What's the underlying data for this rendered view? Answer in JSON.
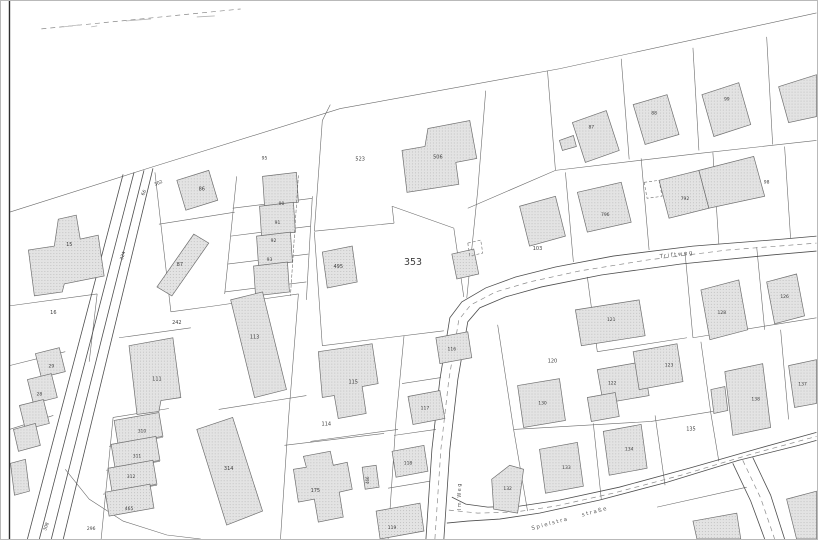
{
  "map": {
    "title_hint": "cadastral parcel map",
    "colors": {
      "background": "#ffffff",
      "boundary": "#6b6b6b",
      "road_edge": "#4e4e4e",
      "road_dash": "#8a8a8a",
      "building_fill": "#e3e3e3",
      "building_dot": "#c3c3c3",
      "building_stroke": "#6f6f6f",
      "label": "#3c3c3c",
      "street_text": "#5a5a5a",
      "frame": "#2e2e2e",
      "tick": "#b5b5b5"
    },
    "main_parcel": {
      "text": "353",
      "x": 413,
      "y": 265,
      "size": 9.5
    },
    "parcel_labels": [
      {
        "text": "523",
        "x": 360,
        "y": 160,
        "size": 5
      },
      {
        "text": "506",
        "x": 438,
        "y": 158,
        "size": 5
      },
      {
        "text": "495",
        "x": 338,
        "y": 268,
        "size": 5
      },
      {
        "text": "86",
        "x": 201,
        "y": 190,
        "size": 5
      },
      {
        "text": "87",
        "x": 179,
        "y": 266,
        "size": 5
      },
      {
        "text": "95",
        "x": 264,
        "y": 159,
        "size": 4.5
      },
      {
        "text": "90",
        "x": 281,
        "y": 205,
        "size": 4.5
      },
      {
        "text": "91",
        "x": 277,
        "y": 224,
        "size": 4.5
      },
      {
        "text": "92",
        "x": 273,
        "y": 242,
        "size": 4.5
      },
      {
        "text": "93",
        "x": 269,
        "y": 261,
        "size": 4.5
      },
      {
        "text": "15",
        "x": 68,
        "y": 246,
        "size": 5
      },
      {
        "text": "16",
        "x": 52,
        "y": 314,
        "size": 5
      },
      {
        "text": "324",
        "x": 123,
        "y": 256,
        "size": 4.5,
        "rot": -73
      },
      {
        "text": "66",
        "x": 144,
        "y": 193,
        "size": 4.5,
        "rot": -63
      },
      {
        "text": "302",
        "x": 158,
        "y": 184,
        "size": 4.5,
        "rot": -25
      },
      {
        "text": "242",
        "x": 176,
        "y": 324,
        "size": 5
      },
      {
        "text": "29",
        "x": 50,
        "y": 368,
        "size": 4.5
      },
      {
        "text": "28",
        "x": 38,
        "y": 396,
        "size": 4.5
      },
      {
        "text": "111",
        "x": 156,
        "y": 381,
        "size": 5
      },
      {
        "text": "310",
        "x": 141,
        "y": 433,
        "size": 4.5
      },
      {
        "text": "311",
        "x": 136,
        "y": 458,
        "size": 4.5
      },
      {
        "text": "312",
        "x": 130,
        "y": 479,
        "size": 4.5
      },
      {
        "text": "465",
        "x": 128,
        "y": 511,
        "size": 4.5
      },
      {
        "text": "314",
        "x": 228,
        "y": 471,
        "size": 5
      },
      {
        "text": "113",
        "x": 254,
        "y": 339,
        "size": 5
      },
      {
        "text": "115",
        "x": 353,
        "y": 384,
        "size": 5
      },
      {
        "text": "114",
        "x": 326,
        "y": 426,
        "size": 5
      },
      {
        "text": "116",
        "x": 452,
        "y": 351,
        "size": 4.5
      },
      {
        "text": "117",
        "x": 425,
        "y": 410,
        "size": 4.5
      },
      {
        "text": "118",
        "x": 408,
        "y": 465,
        "size": 4.5
      },
      {
        "text": "119",
        "x": 392,
        "y": 530,
        "size": 4.5
      },
      {
        "text": "175",
        "x": 315,
        "y": 493,
        "size": 5
      },
      {
        "text": "466",
        "x": 369,
        "y": 481,
        "size": 4,
        "rot": -90
      },
      {
        "text": "103",
        "x": 538,
        "y": 250,
        "size": 5
      },
      {
        "text": "87",
        "x": 592,
        "y": 128,
        "size": 4.5
      },
      {
        "text": "88",
        "x": 655,
        "y": 114,
        "size": 4.5
      },
      {
        "text": "99",
        "x": 728,
        "y": 100,
        "size": 4.5
      },
      {
        "text": "796",
        "x": 606,
        "y": 216,
        "size": 4.5
      },
      {
        "text": "792",
        "x": 686,
        "y": 200,
        "size": 4.5
      },
      {
        "text": "98",
        "x": 768,
        "y": 183,
        "size": 4.5
      },
      {
        "text": "120",
        "x": 553,
        "y": 363,
        "size": 5
      },
      {
        "text": "121",
        "x": 612,
        "y": 321,
        "size": 4.5
      },
      {
        "text": "122",
        "x": 613,
        "y": 385,
        "size": 4.5
      },
      {
        "text": "123",
        "x": 670,
        "y": 367,
        "size": 4.5
      },
      {
        "text": "130",
        "x": 543,
        "y": 405,
        "size": 4.5
      },
      {
        "text": "133",
        "x": 567,
        "y": 470,
        "size": 4.5
      },
      {
        "text": "134",
        "x": 630,
        "y": 451,
        "size": 4.5
      },
      {
        "text": "132",
        "x": 508,
        "y": 491,
        "size": 4.5
      },
      {
        "text": "135",
        "x": 692,
        "y": 431,
        "size": 5
      },
      {
        "text": "128",
        "x": 723,
        "y": 314,
        "size": 4.5
      },
      {
        "text": "126",
        "x": 786,
        "y": 298,
        "size": 4.5
      },
      {
        "text": "137",
        "x": 804,
        "y": 386,
        "size": 4.5
      },
      {
        "text": "138",
        "x": 757,
        "y": 401,
        "size": 4.5
      },
      {
        "text": "308",
        "x": 46,
        "y": 528,
        "size": 4.5,
        "rot": -70
      },
      {
        "text": "296",
        "x": 90,
        "y": 531,
        "size": 4.5
      }
    ],
    "street_names": [
      {
        "text": "Triftweg",
        "x": 678,
        "y": 256,
        "rot": -7,
        "size": 5.5
      },
      {
        "text": "Spielstra",
        "x": 551,
        "y": 526,
        "rot": -15,
        "size": 5.5
      },
      {
        "text": "straße",
        "x": 596,
        "y": 514,
        "rot": -15,
        "size": 5.5
      },
      {
        "text": "Im Weg",
        "x": 461,
        "y": 497,
        "rot": -90,
        "size": 5
      }
    ],
    "buildings": [
      {
        "points": "573,122 607,110 620,150 586,162"
      },
      {
        "points": "560,140 574,135 577,146 563,150"
      },
      {
        "points": "634,104 668,94 680,134 646,144"
      },
      {
        "points": "703,94 740,82 752,124 715,136"
      },
      {
        "points": "780,86 818,74 818,116 790,122"
      },
      {
        "points": "578,192 622,182 632,222 588,232"
      },
      {
        "points": "660,180 700,170 710,208 670,218"
      },
      {
        "points": "700,170 755,156 766,196 710,208"
      },
      {
        "points": "520,206 556,196 566,236 530,246"
      },
      {
        "points": "428,128 470,120 477,158 456,162 459,184 407,192 402,150 425,146"
      },
      {
        "points": "322,252 352,246 357,282 327,288"
      },
      {
        "points": "262,176 296,172 298,202 264,206"
      },
      {
        "points": "259,206 293,202 295,232 261,236"
      },
      {
        "points": "256,236 290,232 292,262 258,266"
      },
      {
        "points": "253,266 287,262 289,292 255,296"
      },
      {
        "points": "176,180 208,170 217,200 185,210"
      },
      {
        "points": "156,287 193,234 208,243 171,296"
      },
      {
        "points": "57,219 75,215 79,239 97,235 103,276 63,284 61,292 33,296 27,250 53,246"
      },
      {
        "points": "34,354 58,348 64,372 40,378"
      },
      {
        "points": "26,380 50,374 56,398 32,404"
      },
      {
        "points": "18,406 42,400 48,424 24,430"
      },
      {
        "points": "12,430 34,424 39,446 17,452"
      },
      {
        "points": "9,464 24,460 28,492 13,496"
      },
      {
        "points": "128,346 172,338 180,398 160,401 158,412 136,415"
      },
      {
        "points": "113,421 158,413 162,437 117,445"
      },
      {
        "points": "110,445 155,437 159,461 114,469"
      },
      {
        "points": "107,469 152,461 156,485 111,493"
      },
      {
        "points": "104,493 149,485 153,509 108,517"
      },
      {
        "points": "196,430 232,418 262,512 226,526"
      },
      {
        "points": "230,300 262,292 286,390 254,398"
      },
      {
        "points": "318,352 372,344 378,384 362,387 366,414 338,419 334,396 322,398"
      },
      {
        "points": "303,457 330,452 333,466 347,463 352,490 339,493 343,518 318,523 314,500 298,503 293,470 306,468"
      },
      {
        "points": "408,397 440,391 445,419 413,425"
      },
      {
        "points": "436,338 468,332 472,358 440,364"
      },
      {
        "points": "392,452 424,446 428,472 396,478"
      },
      {
        "points": "376,512 420,504 424,532 380,540"
      },
      {
        "points": "452,254 474,249 479,274 457,279"
      },
      {
        "points": "362,468 376,466 379,488 365,490"
      },
      {
        "points": "576,310 640,300 646,336 582,346"
      },
      {
        "points": "598,370 644,362 650,396 604,404"
      },
      {
        "points": "588,398 616,393 620,417 592,422"
      },
      {
        "points": "634,352 678,344 684,382 640,390"
      },
      {
        "points": "518,386 560,379 566,421 524,428"
      },
      {
        "points": "540,450 578,443 584,487 546,494"
      },
      {
        "points": "604,432 642,425 648,469 610,476"
      },
      {
        "points": "492,480 510,466 524,470 518,514 494,510"
      },
      {
        "points": "702,290 740,280 749,330 711,340"
      },
      {
        "points": "768,282 798,274 806,316 776,324"
      },
      {
        "points": "790,366 818,360 818,404 796,408"
      },
      {
        "points": "726,372 764,364 772,428 734,436"
      },
      {
        "points": "712,390 726,387 729,411 715,414"
      },
      {
        "points": "788,500 818,492 818,540 798,540"
      },
      {
        "points": "694,522 738,514 742,540 698,540"
      }
    ],
    "dashed_outlines": [
      {
        "points": "645,182 660,180 663,196 648,198"
      },
      {
        "points": "468,243 481,240 483,253 470,256"
      },
      {
        "points": "298,175 290,296"
      }
    ],
    "boundaries": [
      {
        "points": "8,212 150,167 340,108 560,68 818,12"
      },
      {
        "points": "468,208 556,170 700,153 818,140"
      },
      {
        "points": "548,70 556,170"
      },
      {
        "points": "622,58 630,159"
      },
      {
        "points": "694,47 700,150"
      },
      {
        "points": "768,36 774,144"
      },
      {
        "points": "566,172 574,262"
      },
      {
        "points": "642,158 650,250"
      },
      {
        "points": "714,152 720,244"
      },
      {
        "points": "786,146 792,238"
      },
      {
        "points": "486,90 478,190 467,298"
      },
      {
        "points": "330,104 322,120"
      },
      {
        "points": "322,120 314,231"
      },
      {
        "points": "314,231 394,223"
      },
      {
        "points": "394,223 392,206"
      },
      {
        "points": "392,206 454,228"
      },
      {
        "points": "454,228 464,297"
      },
      {
        "points": "314,232 322,346"
      },
      {
        "points": "322,346 444,331"
      },
      {
        "points": "404,336 396,420 388,540"
      },
      {
        "points": "441,378 402,384"
      },
      {
        "points": "436,430 394,436"
      },
      {
        "points": "430,482 388,489"
      },
      {
        "points": "310,442 398,430"
      },
      {
        "points": "284,446 384,434"
      },
      {
        "points": "298,294 288,420 280,540"
      },
      {
        "points": "312,196 306,300"
      },
      {
        "points": "236,176 224,294"
      },
      {
        "points": "232,208 312,198"
      },
      {
        "points": "230,236 310,226"
      },
      {
        "points": "227,264 308,254"
      },
      {
        "points": "224,292 306,282"
      },
      {
        "points": "154,172 170,312"
      },
      {
        "points": "158,224 234,212"
      },
      {
        "points": "170,312 214,306 298,294"
      },
      {
        "points": "118,338 190,328"
      },
      {
        "points": "218,410 306,396"
      },
      {
        "points": "112,418 168,409"
      },
      {
        "points": "112,418 100,540"
      },
      {
        "points": "108,447 162,438"
      },
      {
        "points": "105,471 159,462"
      },
      {
        "points": "102,495 156,486"
      },
      {
        "points": "8,306 96,294"
      },
      {
        "points": "96,294 88,362"
      },
      {
        "points": "8,366 64,352"
      },
      {
        "points": "8,430 52,416"
      },
      {
        "points": "64,470 88,500 122,522 166,536 200,540"
      },
      {
        "points": "588,277 598,352"
      },
      {
        "points": "598,352 688,338"
      },
      {
        "points": "686,252 694,338"
      },
      {
        "points": "694,338 818,318"
      },
      {
        "points": "758,247 766,330"
      },
      {
        "points": "782,330 790,420"
      },
      {
        "points": "702,342 712,414 720,462"
      },
      {
        "points": "514,430 652,422 714,412"
      },
      {
        "points": "594,424 602,500"
      },
      {
        "points": "656,416 666,486"
      },
      {
        "points": "498,325 514,430 528,512"
      },
      {
        "points": "658,508 748,488"
      }
    ],
    "road_edges": [
      {
        "points": "122,174 26,540"
      },
      {
        "points": "133,172 38,540"
      },
      {
        "points": "143,170 50,540"
      },
      {
        "points": "152,168 62,540"
      },
      {
        "points": "426,540 432,450 440,380 450,318 462,302 486,288 516,277 556,267 614,256 694,246 784,239 818,236"
      },
      {
        "points": "444,540 450,450 458,380 468,322 480,308 506,297 542,287 602,275 682,264 772,255 818,251"
      },
      {
        "points": "452,498 466,505 488,508 520,507 560,501 620,488 690,469 760,449 818,433"
      },
      {
        "points": "447,524 468,522 500,520 540,514 600,501 668,483 740,461 800,446 818,441"
      },
      {
        "points": "734,464 752,502 766,540"
      },
      {
        "points": "754,458 772,496 786,540"
      }
    ],
    "road_dashes": [
      {
        "points": "435,540 441,450 449,380 459,320 471,305 496,292 530,282 580,271 648,260 728,250 818,243"
      },
      {
        "points": "449,511 478,514 515,513 556,507 614,494 682,476 752,455 818,437"
      },
      {
        "points": "744,461 762,499 776,540"
      },
      {
        "points": "40,28 240,8"
      }
    ],
    "frame_line": {
      "points": "8,0 8,540"
    },
    "ticks": [
      {
        "points": "62,26 78,24"
      },
      {
        "points": "125,20 150,18"
      },
      {
        "points": "196,16 214,15"
      },
      {
        "points": "90,26 96,25"
      }
    ]
  }
}
